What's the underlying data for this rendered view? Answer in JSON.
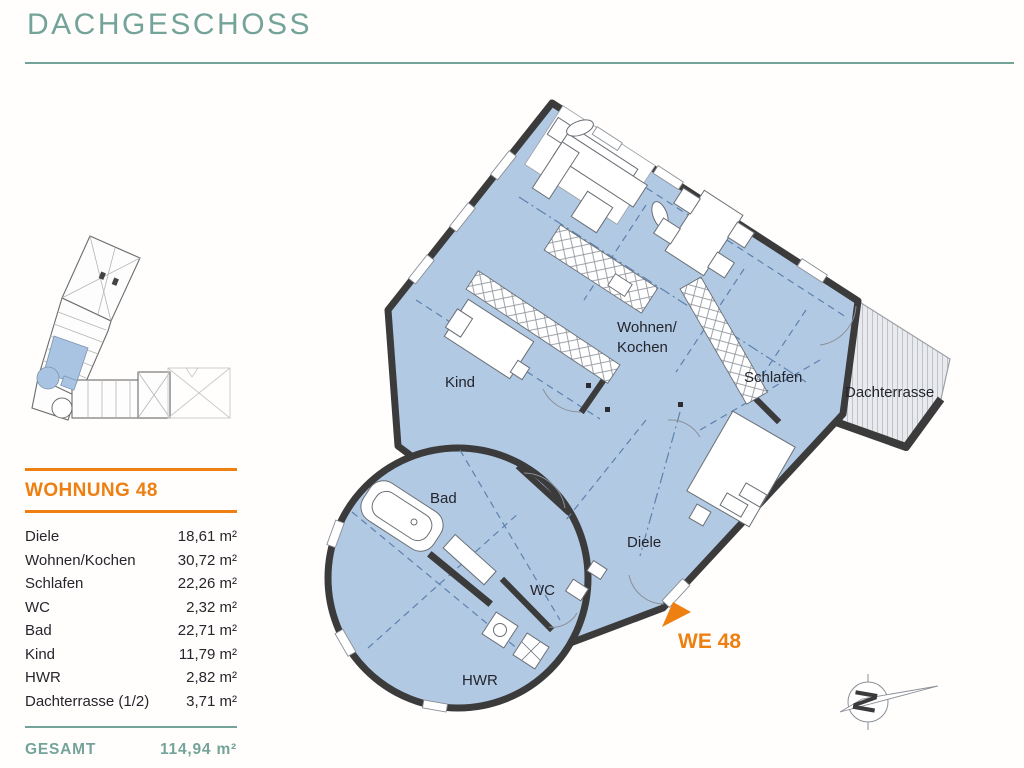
{
  "header": {
    "title": "DACHGESCHOSS"
  },
  "apartment": {
    "name": "WOHNUNG 48",
    "rooms": [
      {
        "label": "Diele",
        "area": "18,61 m²"
      },
      {
        "label": "Wohnen/Kochen",
        "area": "30,72 m²"
      },
      {
        "label": "Schlafen",
        "area": "22,26 m²"
      },
      {
        "label": "WC",
        "area": "2,32 m²"
      },
      {
        "label": "Bad",
        "area": "22,71 m²"
      },
      {
        "label": "Kind",
        "area": "11,79 m²"
      },
      {
        "label": "HWR",
        "area": "2,82 m²"
      },
      {
        "label": "Dachterrasse (1/2)",
        "area": "3,71 m²"
      }
    ],
    "total_label": "GESAMT",
    "total_area": "114,94 m²"
  },
  "floorplan": {
    "labels": {
      "wohnen_line1": "Wohnen/",
      "wohnen_line2": "Kochen",
      "schlafen": "Schlafen",
      "dachterrasse": "Dachterrasse",
      "kind": "Kind",
      "bad": "Bad",
      "diele": "Diele",
      "wc": "WC",
      "hwr": "HWR"
    },
    "unit_marker": "WE 48",
    "compass_letter": "N"
  },
  "colors": {
    "teal": "#74a399",
    "orange": "#ee7f11",
    "plan_blue": "#b2c9e3",
    "wall": "#3b3b3c",
    "terrace_fill": "#e9eaed",
    "dashed_line": "#5d81ad"
  }
}
